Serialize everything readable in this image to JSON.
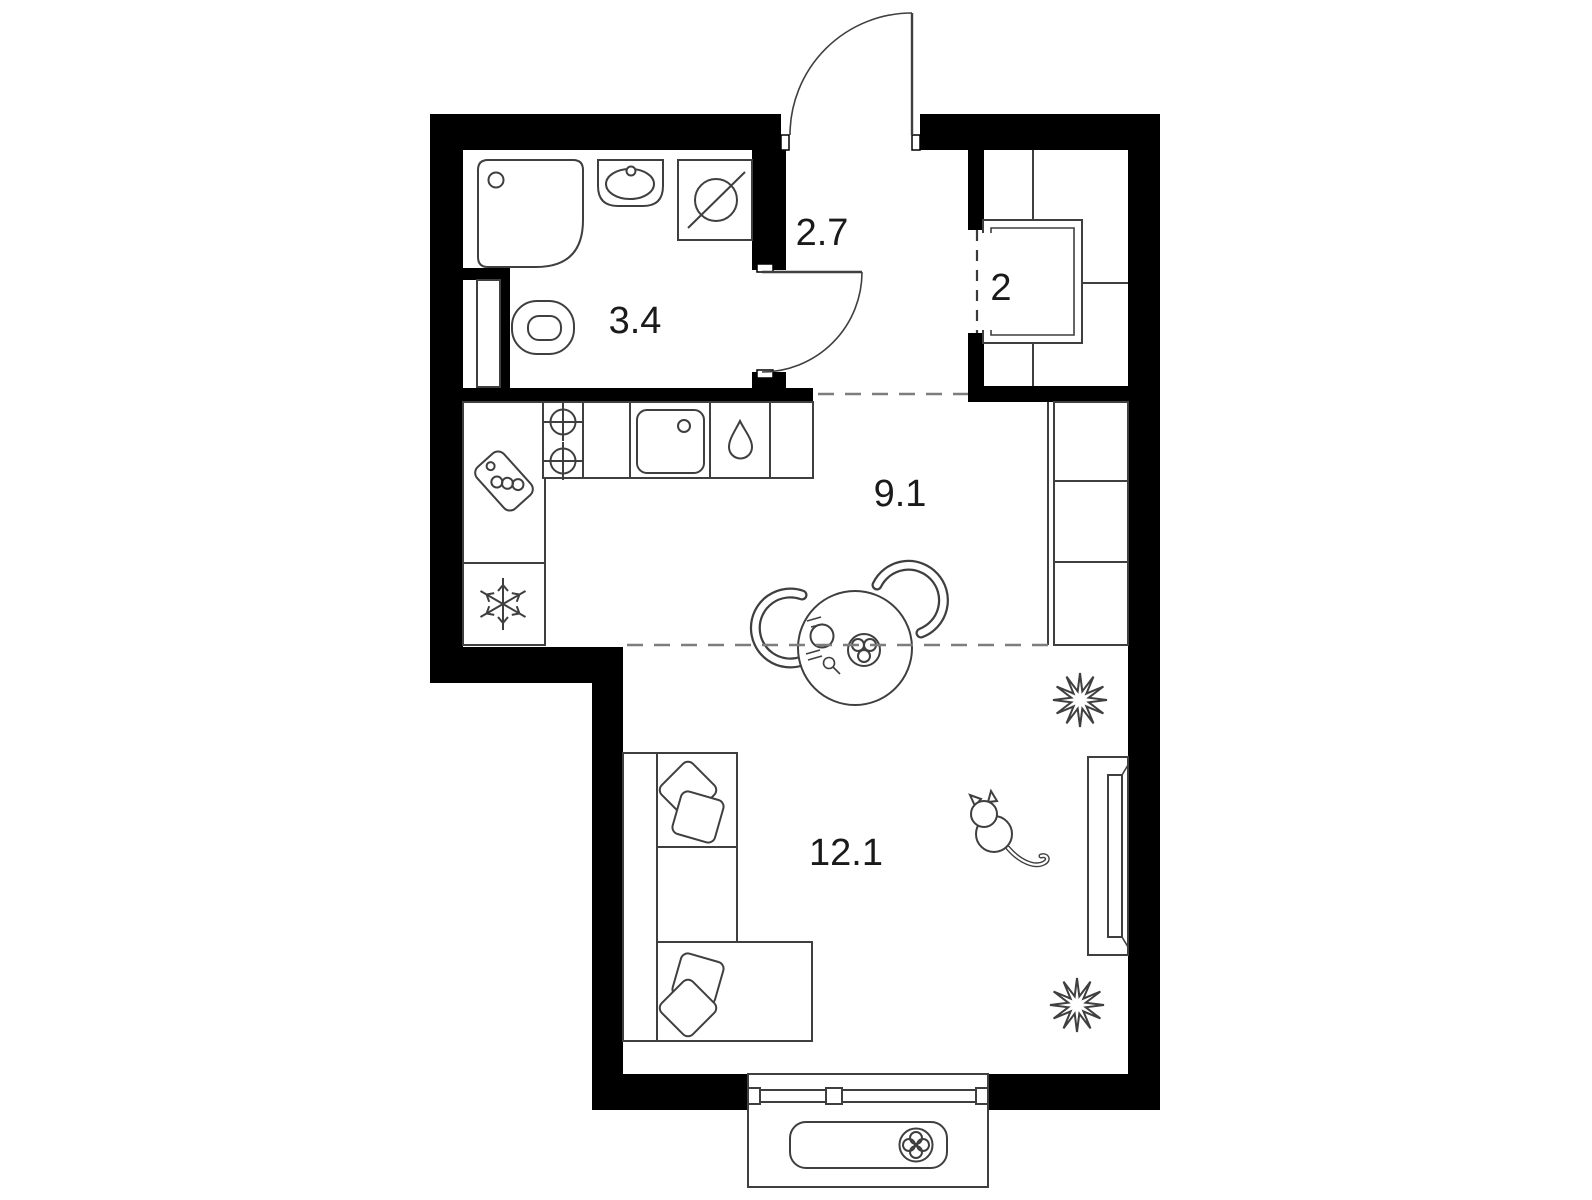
{
  "title": "Studio apartment floor plan",
  "rooms": [
    {
      "name": "bathroom",
      "area": "3.4"
    },
    {
      "name": "hallway",
      "area": "2.7"
    },
    {
      "name": "wardrobe",
      "area": "2"
    },
    {
      "name": "kitchen-dining",
      "area": "9.1"
    },
    {
      "name": "living-room",
      "area": "12.1"
    },
    {
      "name": "balcony",
      "area": ""
    }
  ],
  "fixtures": {
    "bathroom": [
      "shower-tray",
      "washbasin",
      "washing-machine",
      "toilet",
      "plumbing-shaft"
    ],
    "kitchen": [
      "cooktop-two-burners",
      "kitchen-sink",
      "water-drop-dishwasher",
      "cutting-board",
      "refrigerator-snowflake",
      "tall-cabinet-column",
      "dining-table",
      "chair",
      "chair",
      "plate",
      "fruit-bowl"
    ],
    "living_room": [
      "corner-sofa",
      "sofa-pillows",
      "tv-console",
      "tv-screen",
      "plant",
      "plant",
      "cat"
    ],
    "hallway": [
      "entrance-door",
      "bathroom-door"
    ],
    "wardrobe": [
      "built-in-closet",
      "clothes-rail"
    ],
    "balcony": [
      "window-glazing",
      "air-conditioner-fan"
    ]
  },
  "colors": {
    "walls": "#000000",
    "furniture_outline": "#3f3f3f",
    "dashed_boundary": "#7d7d7d",
    "background": "#ffffff",
    "label_text": "#1a1a1a"
  }
}
